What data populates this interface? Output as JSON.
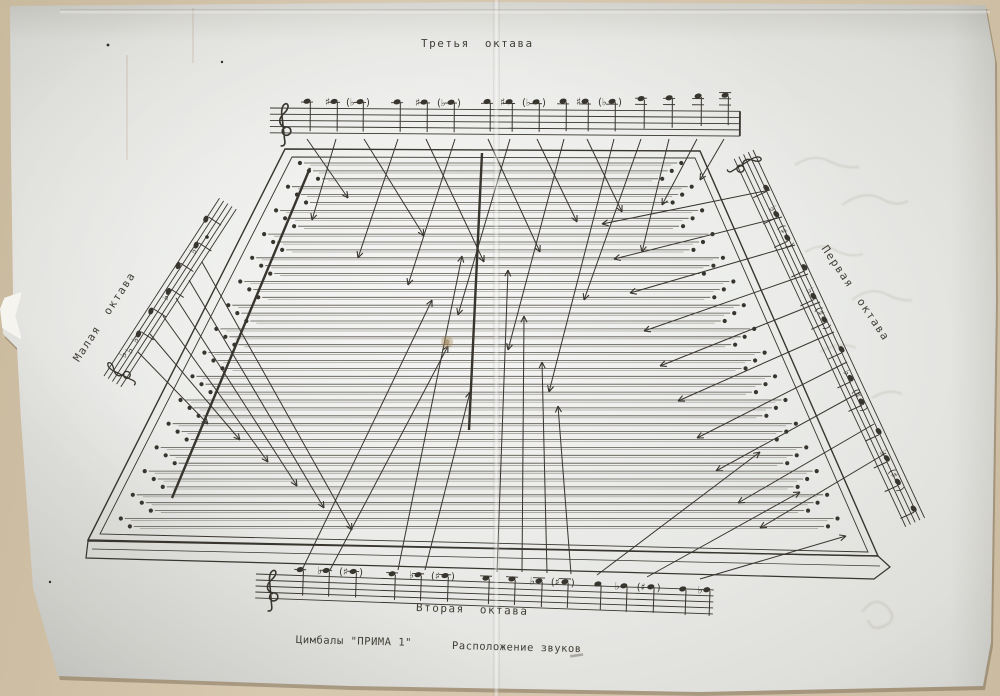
{
  "document": {
    "title_top": "Третья октава",
    "title_bottom": "Вторая октава",
    "title_left": "Малая октава",
    "title_right": "Первая октава",
    "caption_instrument": "Цимбалы \"ПРИМА 1\"",
    "caption_subject": "Расположение звуков"
  },
  "colors": {
    "ink": "#38352e",
    "string": "#57534a",
    "paper": "#e9eae7",
    "backdrop": "#d3c4aa"
  },
  "diagram": {
    "body": {
      "outline": [
        [
          285,
          149
        ],
        [
          700,
          151
        ],
        [
          878,
          556
        ],
        [
          88,
          540
        ]
      ],
      "inner": [
        [
          292,
          157
        ],
        [
          695,
          158
        ],
        [
          868,
          552
        ],
        [
          100,
          534
        ]
      ],
      "front": [
        [
          88,
          541
        ],
        [
          878,
          556
        ],
        [
          890,
          567
        ],
        [
          874,
          579
        ],
        [
          86,
          558
        ]
      ],
      "front_inner": [
        [
          92,
          549
        ],
        [
          880,
          566
        ]
      ]
    },
    "strings": {
      "count": 47,
      "y_top": 163,
      "gap": 7.9,
      "left_edge": {
        "x": 285,
        "y": 149,
        "slope": -0.5038
      },
      "right_edge": {
        "x": 700,
        "y": 151,
        "slope": 0.4395
      },
      "left_inset": 22,
      "right_inset": 24,
      "stagger": [
        0,
        13,
        26
      ]
    },
    "bridges": [
      [
        310,
        168,
        172,
        498
      ],
      [
        482,
        153,
        469,
        430
      ]
    ],
    "arrows": {
      "from_top": [
        [
          307,
          139,
          348,
          198
        ],
        [
          336,
          139,
          312,
          220
        ],
        [
          364,
          139,
          424,
          236
        ],
        [
          398,
          139,
          358,
          258
        ],
        [
          426,
          139,
          484,
          262
        ],
        [
          455,
          139,
          408,
          285
        ],
        [
          488,
          139,
          540,
          252
        ],
        [
          510,
          139,
          458,
          315
        ],
        [
          537,
          139,
          577,
          222
        ],
        [
          564,
          139,
          508,
          350
        ],
        [
          587,
          139,
          622,
          212
        ],
        [
          614,
          139,
          549,
          392
        ],
        [
          641,
          139,
          584,
          300
        ],
        [
          669,
          139,
          642,
          252
        ],
        [
          697,
          139,
          662,
          205
        ],
        [
          724,
          139,
          700,
          180
        ]
      ],
      "from_bottom": [
        [
          302,
          570,
          432,
          300
        ],
        [
          330,
          570,
          448,
          346
        ],
        [
          398,
          570,
          462,
          256
        ],
        [
          425,
          570,
          470,
          392
        ],
        [
          497,
          572,
          508,
          270
        ],
        [
          522,
          572,
          524,
          316
        ],
        [
          547,
          573,
          542,
          362
        ],
        [
          571,
          574,
          558,
          406
        ],
        [
          597,
          575,
          760,
          452
        ],
        [
          647,
          577,
          800,
          492
        ],
        [
          700,
          579,
          846,
          536
        ]
      ],
      "from_left": [
        [
          138,
          352,
          208,
          424
        ],
        [
          150,
          334,
          240,
          440
        ],
        [
          163,
          316,
          268,
          462
        ],
        [
          176,
          298,
          297,
          486
        ],
        [
          189,
          280,
          324,
          508
        ],
        [
          202,
          262,
          352,
          530
        ]
      ],
      "from_right": [
        [
          770,
          190,
          602,
          224
        ],
        [
          782,
          217,
          614,
          259
        ],
        [
          795,
          245,
          630,
          293
        ],
        [
          808,
          274,
          644,
          331
        ],
        [
          820,
          302,
          660,
          366
        ],
        [
          834,
          332,
          678,
          401
        ],
        [
          847,
          362,
          697,
          438
        ],
        [
          860,
          392,
          716,
          471
        ],
        [
          874,
          424,
          738,
          503
        ],
        [
          886,
          453,
          760,
          528
        ]
      ]
    },
    "staves": {
      "top": {
        "x": 270,
        "y": 108,
        "len": 470,
        "gap": 6.2,
        "angle": 0.4,
        "clef_x": 10,
        "stem": 30,
        "end_bar": true,
        "notes": [
          [
            37,
            -7,
            ""
          ],
          [
            64,
            -7,
            "#"
          ],
          [
            90,
            -7,
            "(b)"
          ],
          [
            127,
            -7,
            ""
          ],
          [
            154,
            -7,
            "#"
          ],
          [
            181,
            -7,
            "(b)"
          ],
          [
            217,
            -8,
            ""
          ],
          [
            239,
            -8,
            "#"
          ],
          [
            266,
            -8,
            "(b)"
          ],
          [
            293,
            -9,
            ""
          ],
          [
            315,
            -9,
            "#"
          ],
          [
            342,
            -9,
            "(b)"
          ],
          [
            371,
            -12,
            ""
          ],
          [
            399,
            -13,
            ""
          ],
          [
            428,
            -15,
            ""
          ],
          [
            455,
            -16,
            ""
          ]
        ]
      },
      "bottom": {
        "x": 256,
        "y": 574,
        "len": 458,
        "gap": 6.0,
        "angle": 2.0,
        "clef_x": 12,
        "stem": 26,
        "end_bar": false,
        "notes": [
          [
            44,
            -6,
            ""
          ],
          [
            70,
            -6,
            "b"
          ],
          [
            97,
            -6,
            "(#)"
          ],
          [
            136,
            -5,
            ""
          ],
          [
            162,
            -5,
            "b"
          ],
          [
            189,
            -5,
            "(#)"
          ],
          [
            230,
            -4,
            ""
          ],
          [
            256,
            -4,
            ""
          ],
          [
            283,
            -3,
            "b"
          ],
          [
            309,
            -3,
            "(#)"
          ],
          [
            342,
            -2,
            ""
          ],
          [
            368,
            -1,
            "b"
          ],
          [
            395,
            -1,
            "(#)"
          ],
          [
            427,
            0,
            ""
          ],
          [
            451,
            0,
            "b"
          ]
        ]
      },
      "left": {
        "x": 104,
        "y": 376,
        "len": 212,
        "gap": 5.0,
        "angle": -57,
        "clef_x": 8,
        "stem": 16,
        "end_bar": false,
        "keysig": [
          [
            26,
            4
          ],
          [
            33,
            7
          ]
        ],
        "notes": [
          [
            54,
            6,
            "b"
          ],
          [
            80,
            4,
            ""
          ],
          [
            106,
            8,
            "b"
          ],
          [
            133,
            2,
            ""
          ],
          [
            160,
            6,
            "b"
          ],
          [
            187,
            0,
            ""
          ]
        ]
      },
      "right": {
        "x": 753,
        "y": 150,
        "len": 406,
        "gap": 5.2,
        "angle": 65,
        "clef_x": 6,
        "stem": 16,
        "end_bar": false,
        "notes": [
          [
            40,
            4,
            ""
          ],
          [
            68,
            6,
            "b"
          ],
          [
            94,
            6,
            "(#)"
          ],
          [
            128,
            3,
            ""
          ],
          [
            158,
            7,
            "b"
          ],
          [
            184,
            7,
            "(#)"
          ],
          [
            218,
            4,
            ""
          ],
          [
            248,
            8,
            "b"
          ],
          [
            274,
            8,
            "(#)"
          ],
          [
            308,
            5,
            ""
          ],
          [
            336,
            9,
            "b"
          ],
          [
            362,
            9,
            "(#)"
          ],
          [
            393,
            6,
            ""
          ]
        ]
      }
    },
    "specks": [
      [
        207,
        237,
        1.8
      ],
      [
        50,
        582,
        1.2
      ],
      [
        108,
        45,
        1.4
      ],
      [
        222,
        62,
        1.2
      ]
    ],
    "stain": [
      447,
      342
    ],
    "smudge": [
      570,
      655
    ]
  }
}
